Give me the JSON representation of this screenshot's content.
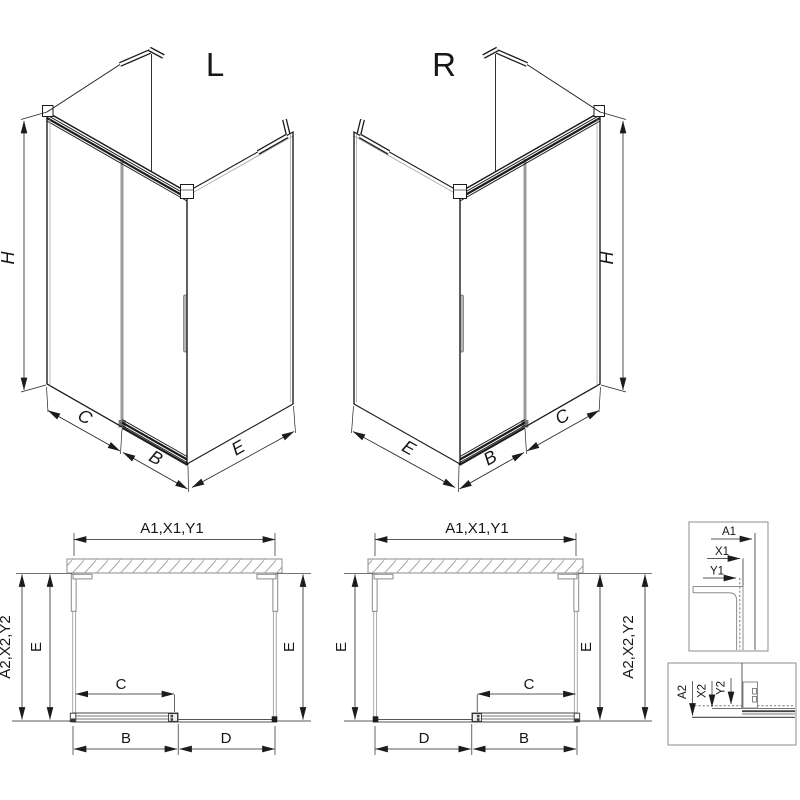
{
  "drawing_type": "shower-enclosure-installation-diagram",
  "colors": {
    "line": "#1c1c1c",
    "dimension": "#222222",
    "gray": "#8c8c8c",
    "glass_gray": "#a0a0a0",
    "divider_gray": "#9a9a9a",
    "background": "#ffffff"
  },
  "iso_left": {
    "label": "L",
    "dim_h": "H",
    "dim_c": "C",
    "dim_b": "B",
    "dim_e": "E"
  },
  "iso_right": {
    "label": "R",
    "dim_h": "H",
    "dim_c": "C",
    "dim_b": "B",
    "dim_e": "E"
  },
  "plan_left": {
    "dim_top": "A1,X1,Y1",
    "dim_left_outer": "A2,X2,Y2",
    "dim_left_inner": "E",
    "dim_right": "E",
    "dim_c": "C",
    "dim_b": "B",
    "dim_d": "D"
  },
  "plan_right": {
    "dim_top": "A1,X1,Y1",
    "dim_left": "E",
    "dim_right_inner": "E",
    "dim_right_outer": "A2,X2,Y2",
    "dim_c": "C",
    "dim_d": "D",
    "dim_b": "B"
  },
  "detail_top": {
    "dim_a1": "A1",
    "dim_x1": "X1",
    "dim_y1": "Y1"
  },
  "detail_bottom": {
    "dim_a2": "A2",
    "dim_x2": "X2",
    "dim_y2": "Y2"
  }
}
